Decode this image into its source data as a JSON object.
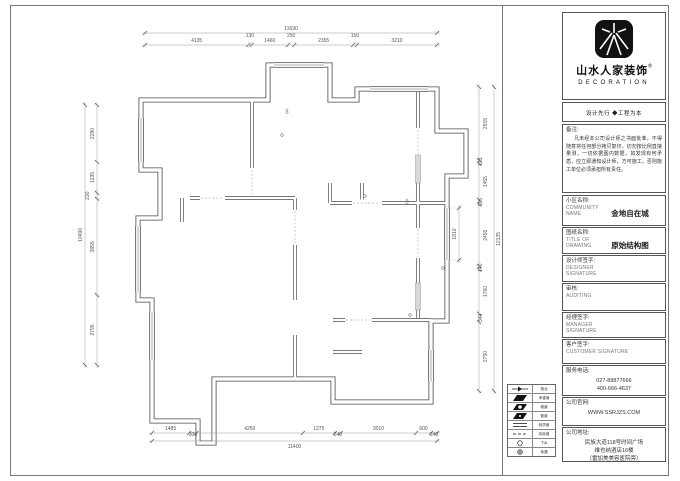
{
  "logo": {
    "brand": "山水人家装饰",
    "reg": "®",
    "sub": "DECORATION",
    "tagline": "设计先行 ◆工程为本"
  },
  "remarks": {
    "label": "备注:",
    "text": "凡未经本公司设计师之书面批准，不得随意将任何部分拷贝复印，切勿按比例直接量测，一切依据图内数据，如发现有何矛盾，应立即通知设计师，方可施工，否则施工单位必须承担所有责任。"
  },
  "fields": [
    {
      "label": "小区名称:",
      "en": "COMMUNITY\nNAME",
      "value": "金地自在城"
    },
    {
      "label": "图纸名称:",
      "en": "TITLE  OF\nDRAWING",
      "value": "原始结构图"
    },
    {
      "label": "设计师签字:",
      "en": "DESIGNER\nSIGNATURE",
      "value": ""
    },
    {
      "label": "审核:",
      "en": "AUDITING",
      "value": ""
    },
    {
      "label": "经理签字:",
      "en": "MANAGER\nSIGNATURE",
      "value": ""
    },
    {
      "label": "客户签字:",
      "en": "CUSTOMER  SIGNATURE",
      "value": ""
    },
    {
      "label": "服务电话:",
      "en": "",
      "value": "027-88877666\n400-666-4637"
    },
    {
      "label": "公司官网:",
      "en": "",
      "value": "WWW.SSRJZS.COM"
    },
    {
      "label": "公司地址:",
      "en": "",
      "value": "民族大道118号时间广场\n维也纳酒店16楼\n（雷加美美容医院旁）"
    }
  ],
  "legend": {
    "rows": [
      {
        "label": "指北"
      },
      {
        "label": "承重墙"
      },
      {
        "label": "烟道"
      },
      {
        "label": "管道"
      },
      {
        "label": "轻质墙"
      },
      {
        "label": "拆除墙"
      },
      {
        "label": "下水"
      },
      {
        "label": "地漏"
      }
    ]
  },
  "dims": {
    "top": {
      "total": "11690",
      "segments": [
        4135,
        130,
        1460,
        250,
        2355,
        150,
        3210
      ]
    },
    "bottom": {
      "total": "11400",
      "segments": [
        1485,
        300,
        4250,
        1275,
        240,
        3010,
        600,
        240
      ]
    },
    "left": {
      "total": "10490",
      "segments": [
        2280,
        1235,
        230,
        3855,
        2795
      ]
    },
    "right": {
      "total": "12135",
      "segments": [
        2915,
        135,
        1455,
        185,
        2455,
        140,
        1760,
        340,
        2750
      ]
    },
    "interior": [
      {
        "label": "1810"
      }
    ]
  }
}
